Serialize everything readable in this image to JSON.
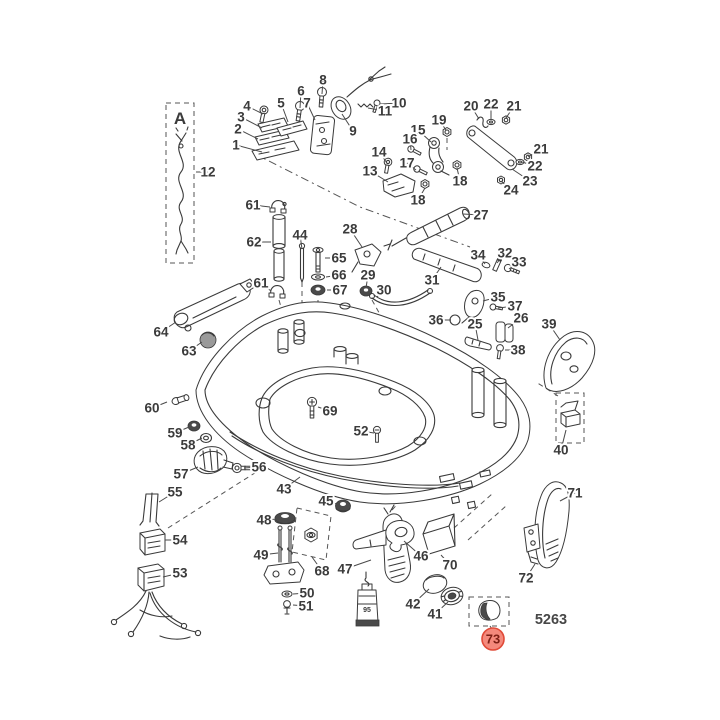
{
  "page": {
    "background": "#ffffff",
    "line_color": "#3a3a3a",
    "label_color": "#3b3b3b"
  },
  "diagram": {
    "inset_label": "A",
    "drawing_number": "5263",
    "lube_tube_label": "95",
    "highlight": {
      "label": "73",
      "fill": "#f4897c",
      "stroke": "#e04a38",
      "text_color": "#7c1f15"
    },
    "callouts": [
      {
        "label": "1",
        "x": 236,
        "y": 145,
        "tx": 262,
        "ty": 152
      },
      {
        "label": "2",
        "x": 238,
        "y": 129,
        "tx": 258,
        "ty": 139
      },
      {
        "label": "3",
        "x": 241,
        "y": 117,
        "tx": 262,
        "ty": 128
      },
      {
        "label": "4",
        "x": 247,
        "y": 106,
        "tx": 263,
        "ty": 114
      },
      {
        "label": "5",
        "x": 281,
        "y": 103,
        "tx": 288,
        "ty": 122
      },
      {
        "label": "6",
        "x": 301,
        "y": 91,
        "tx": 300,
        "ty": 108
      },
      {
        "label": "7",
        "x": 307,
        "y": 103,
        "tx": 315,
        "ty": 120
      },
      {
        "label": "8",
        "x": 323,
        "y": 80,
        "tx": 322,
        "ty": 94
      },
      {
        "label": "9",
        "x": 353,
        "y": 131,
        "tx": 342,
        "ty": 114
      },
      {
        "label": "10",
        "x": 399,
        "y": 103,
        "tx": 380,
        "ty": 104
      },
      {
        "label": "11",
        "x": 385,
        "y": 111,
        "tx": 368,
        "ty": 108
      },
      {
        "label": "12",
        "x": 208,
        "y": 172,
        "tx": 196,
        "ty": 172
      },
      {
        "label": "13",
        "x": 370,
        "y": 171,
        "tx": 388,
        "ty": 182
      },
      {
        "label": "14",
        "x": 379,
        "y": 152,
        "tx": 387,
        "ty": 163
      },
      {
        "label": "15",
        "x": 418,
        "y": 130,
        "tx": 431,
        "ty": 142
      },
      {
        "label": "16",
        "x": 410,
        "y": 139,
        "tx": 411,
        "ty": 150
      },
      {
        "label": "17",
        "x": 407,
        "y": 163,
        "tx": 416,
        "ty": 170
      },
      {
        "label": "18",
        "x": 418,
        "y": 200,
        "tx": 425,
        "ty": 188
      },
      {
        "label": "18",
        "x": 460,
        "y": 181,
        "tx": 457,
        "ty": 168
      },
      {
        "label": "19",
        "x": 439,
        "y": 120,
        "tx": 446,
        "ty": 130
      },
      {
        "label": "20",
        "x": 471,
        "y": 106,
        "tx": 479,
        "ty": 119
      },
      {
        "label": "21",
        "x": 514,
        "y": 106,
        "tx": 506,
        "ty": 118
      },
      {
        "label": "21",
        "x": 541,
        "y": 149,
        "tx": 528,
        "ty": 157
      },
      {
        "label": "22",
        "x": 491,
        "y": 104,
        "tx": 491,
        "ty": 119
      },
      {
        "label": "22",
        "x": 535,
        "y": 166,
        "tx": 522,
        "ty": 162
      },
      {
        "label": "23",
        "x": 530,
        "y": 181,
        "tx": 512,
        "ty": 169
      },
      {
        "label": "24",
        "x": 511,
        "y": 190,
        "tx": 501,
        "ty": 181
      },
      {
        "label": "25",
        "x": 475,
        "y": 324,
        "tx": 478,
        "ty": 340
      },
      {
        "label": "26",
        "x": 521,
        "y": 318,
        "tx": 508,
        "ty": 328
      },
      {
        "label": "27",
        "x": 481,
        "y": 215,
        "tx": 463,
        "ty": 214
      },
      {
        "label": "28",
        "x": 350,
        "y": 229,
        "tx": 362,
        "ty": 247
      },
      {
        "label": "29",
        "x": 368,
        "y": 275,
        "tx": 366,
        "ty": 288
      },
      {
        "label": "30",
        "x": 384,
        "y": 290,
        "tx": 377,
        "ty": 297
      },
      {
        "label": "31",
        "x": 432,
        "y": 280,
        "tx": 441,
        "ty": 267
      },
      {
        "label": "32",
        "x": 505,
        "y": 253,
        "tx": 497,
        "ty": 263
      },
      {
        "label": "33",
        "x": 519,
        "y": 262,
        "tx": 509,
        "ty": 269
      },
      {
        "label": "34",
        "x": 478,
        "y": 255,
        "tx": 485,
        "ty": 264
      },
      {
        "label": "35",
        "x": 498,
        "y": 297,
        "tx": 483,
        "ty": 301
      },
      {
        "label": "36",
        "x": 436,
        "y": 320,
        "tx": 451,
        "ty": 320
      },
      {
        "label": "37",
        "x": 515,
        "y": 306,
        "tx": 498,
        "ty": 308
      },
      {
        "label": "38",
        "x": 518,
        "y": 350,
        "tx": 505,
        "ty": 350
      },
      {
        "label": "39",
        "x": 549,
        "y": 324,
        "tx": 560,
        "ty": 340
      },
      {
        "label": "40",
        "x": 561,
        "y": 450,
        "tx": 566,
        "ty": 430
      },
      {
        "label": "41",
        "x": 435,
        "y": 614,
        "tx": 448,
        "ty": 602
      },
      {
        "label": "42",
        "x": 413,
        "y": 604,
        "tx": 429,
        "ty": 589
      },
      {
        "label": "43",
        "x": 284,
        "y": 489,
        "tx": 300,
        "ty": 477
      },
      {
        "label": "44",
        "x": 300,
        "y": 235,
        "tx": 302,
        "ty": 249
      },
      {
        "label": "45",
        "x": 326,
        "y": 501,
        "tx": 340,
        "ty": 505
      },
      {
        "label": "46",
        "x": 421,
        "y": 556,
        "tx": 404,
        "ty": 541
      },
      {
        "label": "47",
        "x": 345,
        "y": 569,
        "tx": 371,
        "ty": 560
      },
      {
        "label": "48",
        "x": 264,
        "y": 520,
        "tx": 278,
        "ty": 519
      },
      {
        "label": "49",
        "x": 261,
        "y": 555,
        "tx": 278,
        "ty": 553
      },
      {
        "label": "50",
        "x": 307,
        "y": 593,
        "tx": 293,
        "ty": 594
      },
      {
        "label": "51",
        "x": 306,
        "y": 606,
        "tx": 293,
        "ty": 605
      },
      {
        "label": "52",
        "x": 361,
        "y": 431,
        "tx": 374,
        "ty": 433
      },
      {
        "label": "53",
        "x": 180,
        "y": 573,
        "tx": 163,
        "ty": 577
      },
      {
        "label": "54",
        "x": 180,
        "y": 540,
        "tx": 165,
        "ty": 540
      },
      {
        "label": "55",
        "x": 175,
        "y": 492,
        "tx": 159,
        "ty": 502
      },
      {
        "label": "56",
        "x": 259,
        "y": 467,
        "tx": 244,
        "ty": 468
      },
      {
        "label": "57",
        "x": 181,
        "y": 474,
        "tx": 198,
        "ty": 467
      },
      {
        "label": "58",
        "x": 188,
        "y": 445,
        "tx": 202,
        "ty": 438
      },
      {
        "label": "59",
        "x": 175,
        "y": 433,
        "tx": 189,
        "ty": 427
      },
      {
        "label": "60",
        "x": 152,
        "y": 408,
        "tx": 167,
        "ty": 402
      },
      {
        "label": "61",
        "x": 253,
        "y": 205,
        "tx": 270,
        "ty": 207
      },
      {
        "label": "61",
        "x": 261,
        "y": 283,
        "tx": 271,
        "ty": 291
      },
      {
        "label": "62",
        "x": 254,
        "y": 242,
        "tx": 271,
        "ty": 242
      },
      {
        "label": "63",
        "x": 189,
        "y": 351,
        "tx": 202,
        "ty": 342
      },
      {
        "label": "64",
        "x": 161,
        "y": 332,
        "tx": 176,
        "ty": 322
      },
      {
        "label": "65",
        "x": 339,
        "y": 258,
        "tx": 325,
        "ty": 258
      },
      {
        "label": "66",
        "x": 339,
        "y": 275,
        "tx": 326,
        "ty": 277
      },
      {
        "label": "67",
        "x": 340,
        "y": 290,
        "tx": 327,
        "ty": 290
      },
      {
        "label": "68",
        "x": 322,
        "y": 571,
        "tx": 312,
        "ty": 557
      },
      {
        "label": "69",
        "x": 330,
        "y": 411,
        "tx": 318,
        "ty": 407
      },
      {
        "label": "70",
        "x": 450,
        "y": 565,
        "tx": 441,
        "ty": 555
      },
      {
        "label": "71",
        "x": 575,
        "y": 493,
        "tx": 560,
        "ty": 501
      },
      {
        "label": "72",
        "x": 526,
        "y": 578,
        "tx": 535,
        "ty": 564
      }
    ]
  }
}
